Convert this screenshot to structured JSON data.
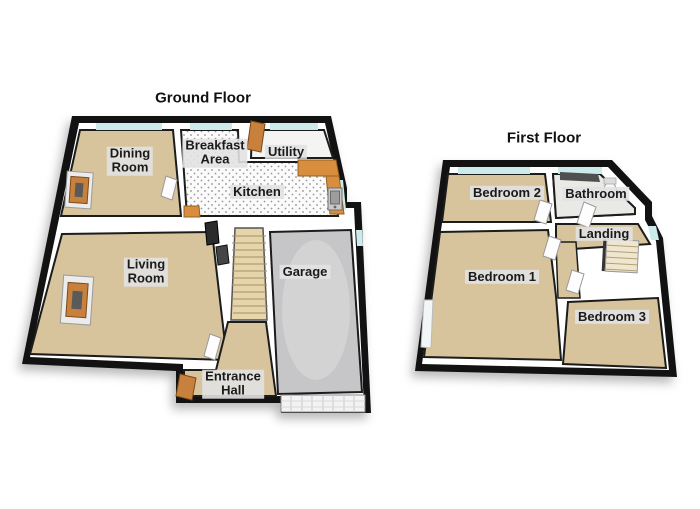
{
  "ground_floor": {
    "title": "Ground Floor",
    "rooms": {
      "dining": {
        "label": "Dining\nRoom"
      },
      "breakfast": {
        "label": "Breakfast\nArea"
      },
      "utility": {
        "label": "Utility"
      },
      "kitchen": {
        "label": "Kitchen"
      },
      "living": {
        "label": "Living\nRoom"
      },
      "garage": {
        "label": "Garage"
      },
      "entrance": {
        "label": "Entrance\nHall"
      }
    }
  },
  "first_floor": {
    "title": "First Floor",
    "rooms": {
      "bedroom2": {
        "label": "Bedroom 2"
      },
      "bathroom": {
        "label": "Bathroom"
      },
      "landing": {
        "label": "Landing"
      },
      "bedroom1": {
        "label": "Bedroom 1"
      },
      "bedroom3": {
        "label": "Bedroom 3"
      }
    }
  },
  "colors": {
    "background": "#ffffff",
    "wall": "#121212",
    "inner_wall": "#ffffff",
    "carpet": "#d7c49c",
    "carpet_light": "#e6d5ab",
    "tile": "#fbfbfb",
    "garage_floor": "#c6c6c8",
    "window_glass": "#cdeaea",
    "wood": "#c8813c",
    "counter": "#d98e3f",
    "label_bg": "#e2e2e2",
    "label_text": "#1a1a1a"
  }
}
